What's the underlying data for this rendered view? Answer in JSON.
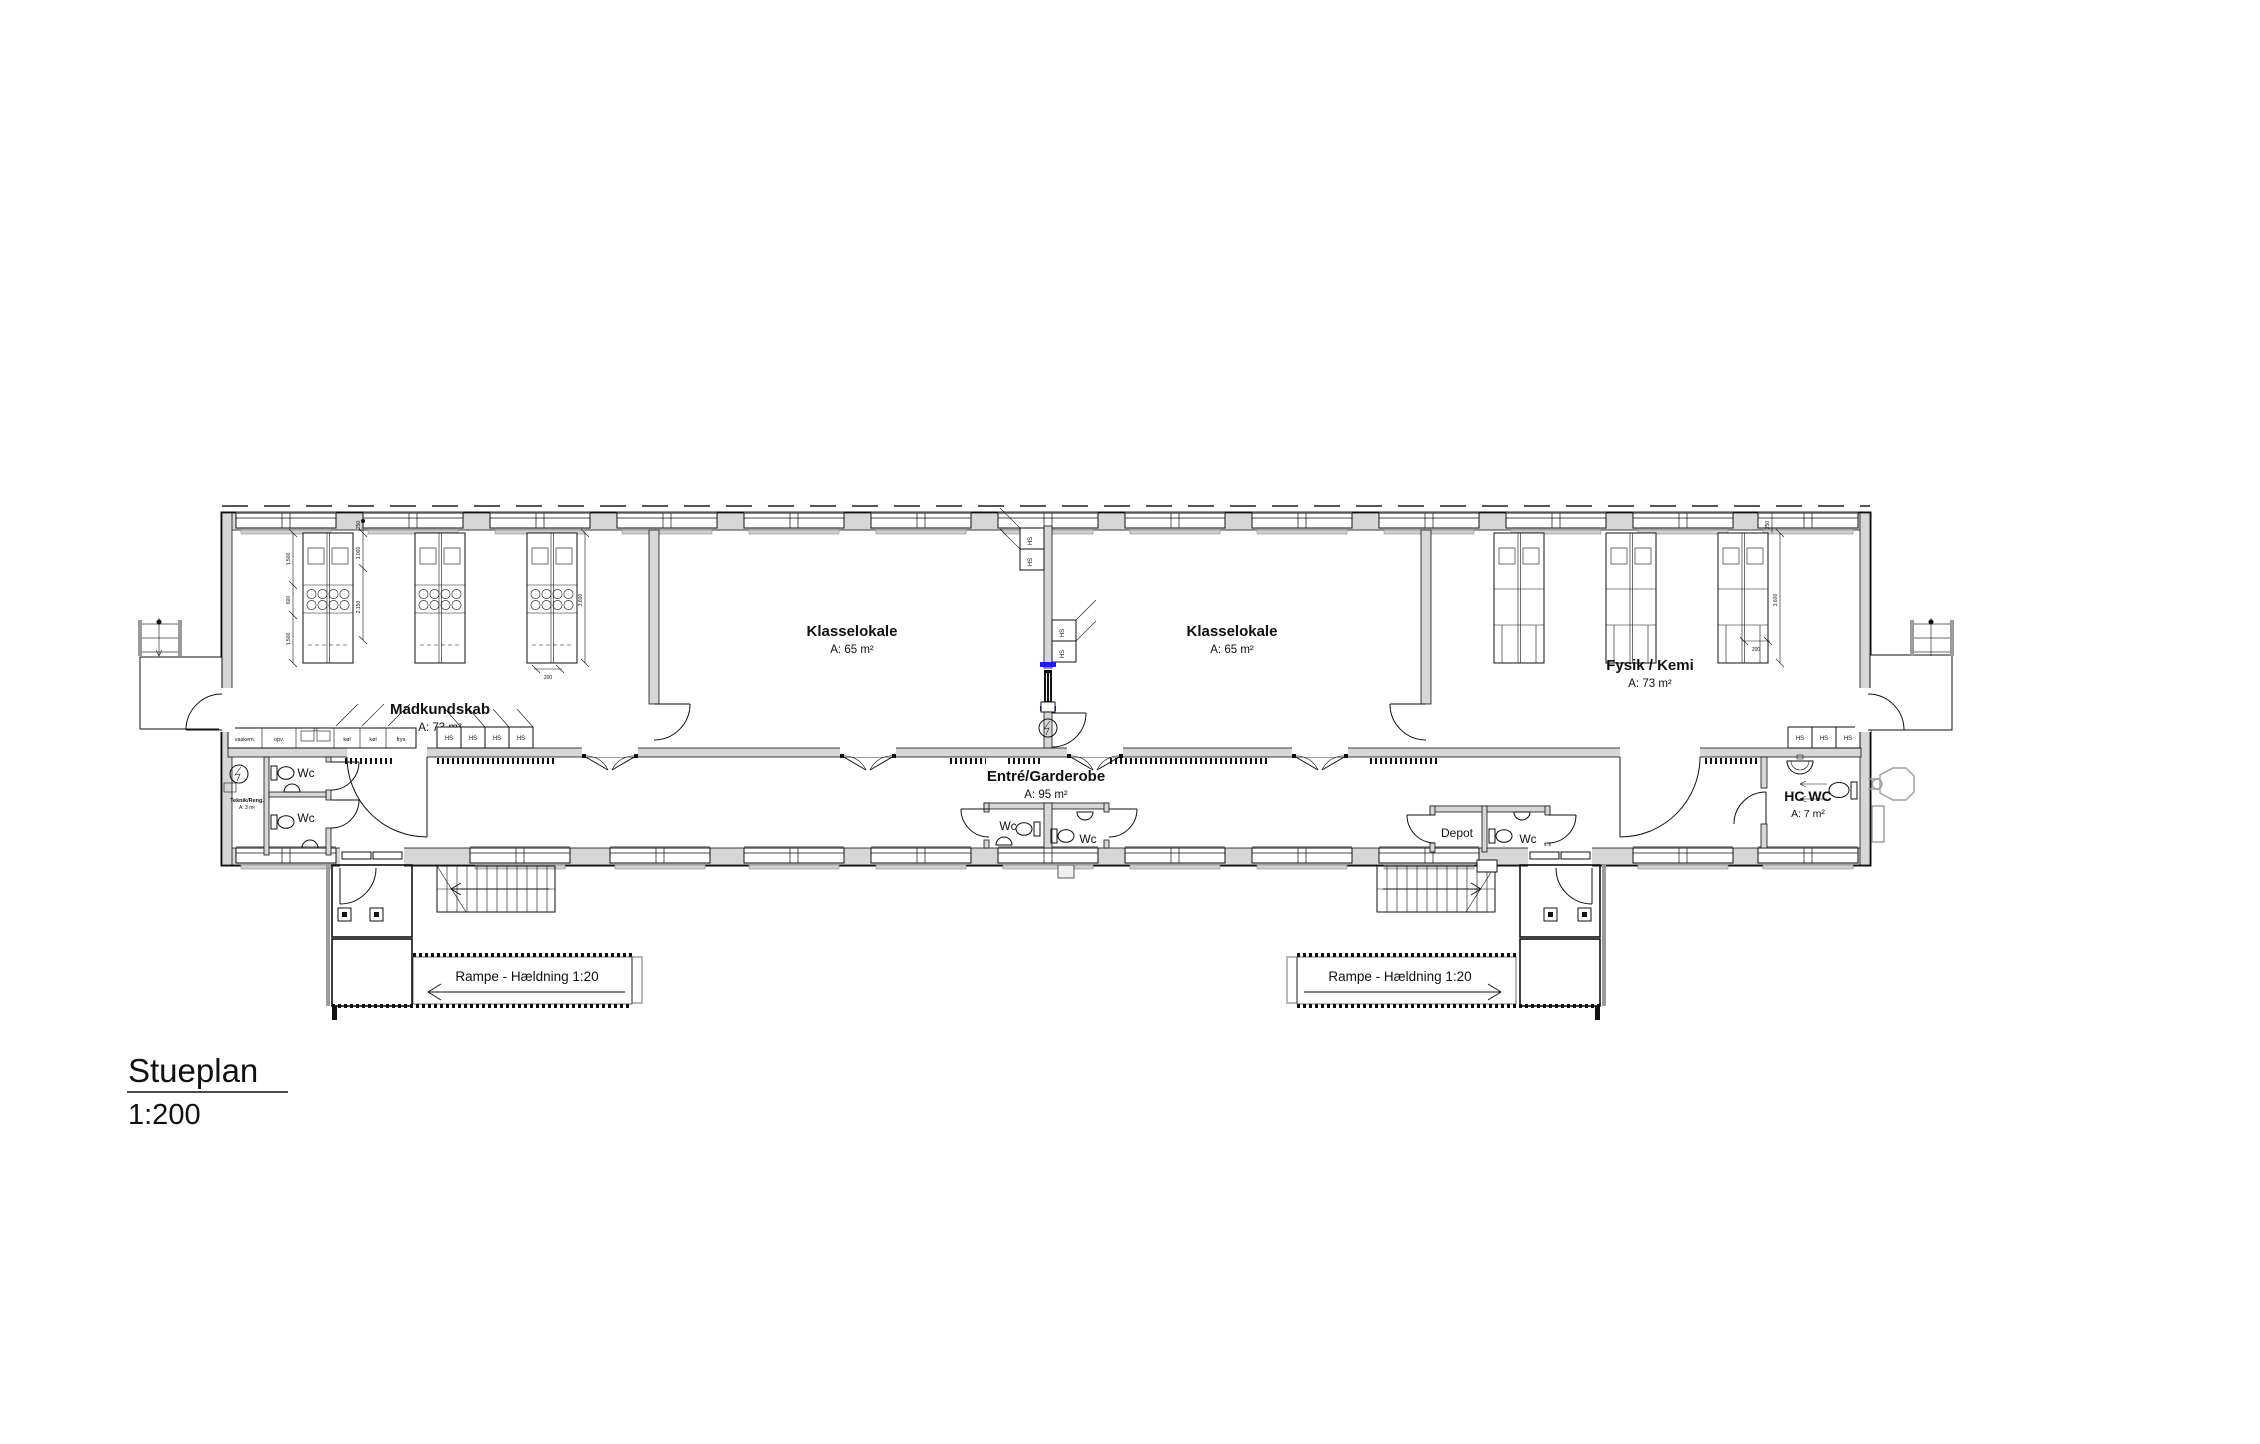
{
  "title_block": {
    "name": "Stueplan",
    "scale": "1:200"
  },
  "rooms": {
    "madkundskab": {
      "label": "Madkundskab",
      "area": "A: 73 m²"
    },
    "klasselokale_left": {
      "label": "Klasselokale",
      "area": "A: 65 m²"
    },
    "klasselokale_right": {
      "label": "Klasselokale",
      "area": "A: 65 m²"
    },
    "fysik_kemi": {
      "label": "Fysik / Kemi",
      "area": "A: 73 m²"
    },
    "entre_garderobe": {
      "label": "Entré/Garderobe",
      "area": "A: 95 m²"
    },
    "hc_wc": {
      "label": "HC WC",
      "area": "A: 7 m²"
    },
    "teknik_reng": {
      "label": "Teknik/Reng.",
      "area": "A: 3 m²"
    },
    "depot": {
      "label": "Depot"
    }
  },
  "labels": {
    "wc": "Wc",
    "locker": "HS"
  },
  "ramps": {
    "left": "Rampe - Hældning 1:20",
    "right": "Rampe - Hældning 1:20"
  },
  "kitchen_units": {
    "washer": "vaskem.",
    "dishwasher": "opv.",
    "fridge1": "køl",
    "fridge2": "køl",
    "freezer": "frys"
  },
  "dimensions": {
    "d250": "250",
    "d1500": "1.500",
    "d600": "600",
    "d1000": "1.000",
    "d2150": "2.150",
    "d3600": "3.600",
    "d200": "200"
  },
  "colors": {
    "wall_fill": "#d7d7d7",
    "line": "#111111",
    "door_accent": "#2020d0",
    "symbol_gray": "#9b9b9b"
  }
}
